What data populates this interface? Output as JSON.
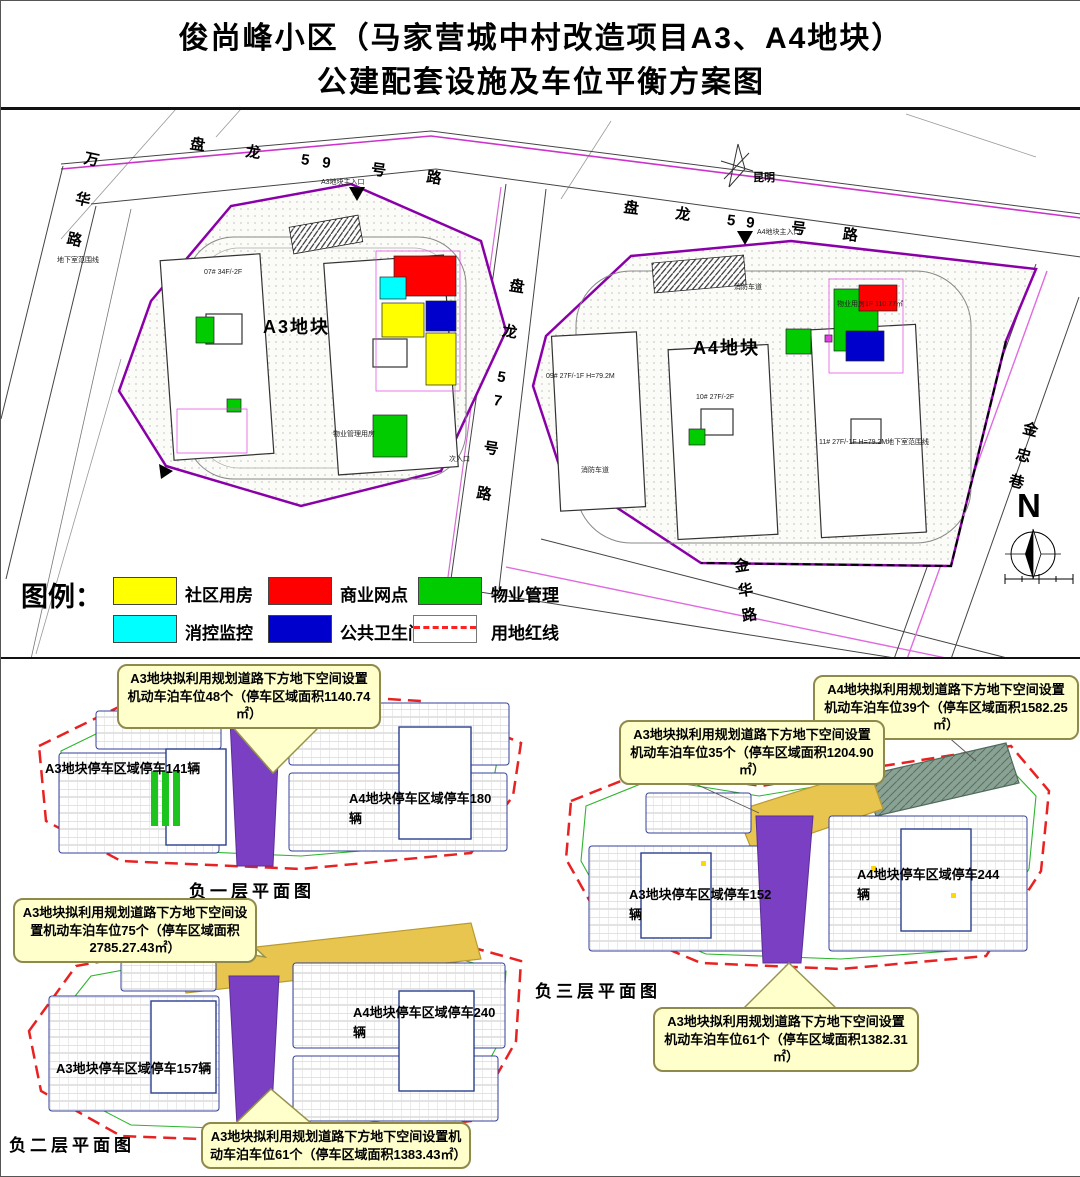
{
  "title": {
    "line1": "俊尚峰小区（马家营城中村改造项目A3、A4地块）",
    "line2": "公建配套设施及车位平衡方案图"
  },
  "site_plan": {
    "plot_a3": "A3地块",
    "plot_a4": "A4地块",
    "roads": {
      "wanhua": "万华路",
      "panlong59_west": "盘　龙　59　号　路",
      "panlong59_east": "盘　龙　59　号　路",
      "panlong57": "盘 龙 57 号 路",
      "jinhua": "金华路",
      "jinzhong": "金忠巷"
    },
    "city_label": "昆明",
    "compass_n": "N",
    "entrances": {
      "west": "A3地块主入口",
      "east": "A4地块主入口",
      "side": "次入口"
    },
    "notes": {
      "basement_line_1": "地下室范围线",
      "basement_line_2": "地下室范围线",
      "fire_lane_1": "消防车道",
      "fire_lane_2": "消防车道"
    },
    "buildings": {
      "a3_1": "07# 34F/-2F",
      "a3_pm": "物业管理用房",
      "a4_1": "09# 27F/-1F H=79.2M",
      "a4_2": "10# 27F/-2F",
      "a4_3": "11# 27F/-1F H=79.2M",
      "a4_pm": "物业用房1F 110.77㎡"
    }
  },
  "legend": {
    "title": "图例：",
    "items": [
      {
        "label": "社区用房",
        "color": "#ffff00"
      },
      {
        "label": "商业网点",
        "color": "#ff0000"
      },
      {
        "label": "物业管理",
        "color": "#00cc00"
      },
      {
        "label": "消控监控",
        "color": "#00ffff"
      },
      {
        "label": "公共卫生间",
        "color": "#0000cc"
      },
      {
        "label": "用地红线",
        "color": "#ff2222"
      }
    ]
  },
  "floors": {
    "b1": {
      "title": "负一层平面图",
      "area_a3": "A3地块停车区域停车141辆",
      "area_a4": "A4地块停车区域停车180辆",
      "callout_48": "A3地块拟利用规划道路下方地下空间设置机动车泊车位48个（停车区域面积1140.74㎡）"
    },
    "b2": {
      "title": "负二层平面图",
      "area_a3": "A3地块停车区域停车157辆",
      "area_a4": "A4地块停车区域停车240辆",
      "callout_75": "A3地块拟利用规划道路下方地下空间设置机动车泊车位75个（停车区域面积2785.27.43㎡）",
      "callout_61": "A3地块拟利用规划道路下方地下空间设置机动车泊车位61个（停车区域面积1383.43㎡）"
    },
    "b3": {
      "title": "负三层平面图",
      "area_a3": "A3地块停车区域停车152辆",
      "area_a4": "A4地块停车区域停车244辆",
      "callout_39": "A4地块拟利用规划道路下方地下空间设置机动车泊车位39个（停车区域面积1582.25㎡）",
      "callout_35": "A3地块拟利用规划道路下方地下空间设置机动车泊车位35个（停车区域面积1204.90㎡）",
      "callout_61": "A3地块拟利用规划道路下方地下空间设置机动车泊车位61个（停车区域面积1382.31㎡）"
    }
  },
  "colors": {
    "boundary_purple": "#8a00a8",
    "red_line": "#e82222",
    "parking_road_purple": "#7b3fc4",
    "planned_road_gold": "#e8c54e",
    "ramp_strip_green": "#8aa294",
    "callout_bg": "#ffffcc"
  }
}
